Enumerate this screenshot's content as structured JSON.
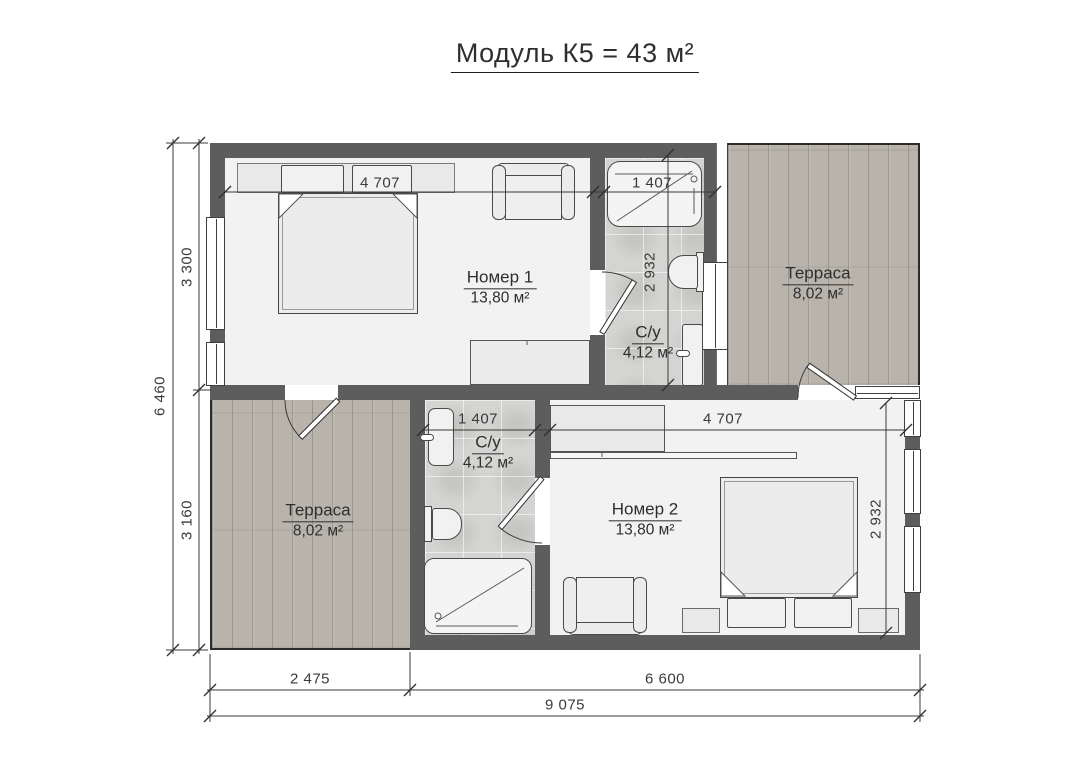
{
  "title": {
    "text": "Модуль К5 = 43 м²"
  },
  "rooms": {
    "room1": {
      "name": "Номер 1",
      "area": "13,80 м²"
    },
    "bath1": {
      "name": "С/у",
      "area": "4,12 м²"
    },
    "terrace1": {
      "name": "Терраса",
      "area": "8,02 м²"
    },
    "terrace2": {
      "name": "Терраса",
      "area": "8,02 м²"
    },
    "bath2": {
      "name": "С/у",
      "area": "4,12 м²"
    },
    "room2": {
      "name": "Номер 2",
      "area": "13,80 м²"
    }
  },
  "dimensions": {
    "left_total": "6 460",
    "left_top": "3 300",
    "left_bottom": "3 160",
    "bottom_segment1": "2 475",
    "bottom_segment2": "6 600",
    "bottom_total": "9 075",
    "room1_width": "4 707",
    "bath1_width": "1 407",
    "bath1_depth": "2 932",
    "bath2_width": "1 407",
    "room2_width": "4 707",
    "room2_depth": "2 932"
  },
  "colors": {
    "wall": "#5d5d5d",
    "floor": "#f2f2f2",
    "tile": "#d4d4d2",
    "terrace": "#b8b4ab",
    "line": "#3a3a3a"
  }
}
